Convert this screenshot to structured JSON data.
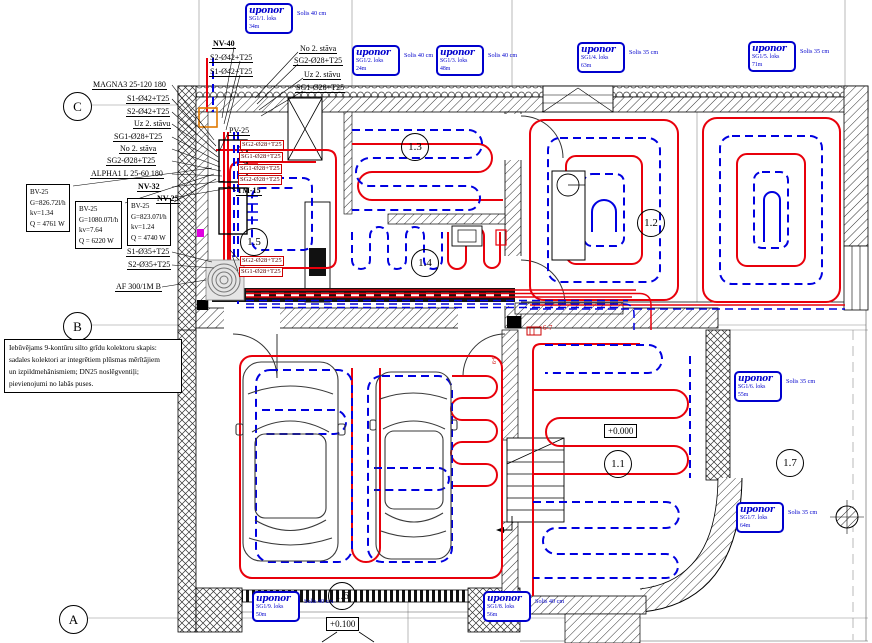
{
  "badges": [
    {
      "logo": "uponor",
      "loop": "SG1/1. loks",
      "len": "34m",
      "step": "Solis 40 cm"
    },
    {
      "logo": "uponor",
      "loop": "SG1/2. loks",
      "len": "24m",
      "step": "Solis 40 cm"
    },
    {
      "logo": "uponor",
      "loop": "SG1/3. loks",
      "len": "48m",
      "step": "Solis 40 cm"
    },
    {
      "logo": "uponor",
      "loop": "SG1/4. loks",
      "len": "63m",
      "step": "Solis 35 cm"
    },
    {
      "logo": "uponor",
      "loop": "SG1/5. loks",
      "len": "71m",
      "step": "Solis 35 cm"
    },
    {
      "logo": "uponor",
      "loop": "SG1/6. loks",
      "len": "55m",
      "step": "Solis 35 cm"
    },
    {
      "logo": "uponor",
      "loop": "SG1/7. loks",
      "len": "64m",
      "step": "Solis 35 cm"
    },
    {
      "logo": "uponor",
      "loop": "SG1/8. loks",
      "len": "56m",
      "step": "Solis 40 cm"
    },
    {
      "logo": "uponor",
      "loop": "SG1/9. loks",
      "len": "50m",
      "step": "Solis 40 cm"
    }
  ],
  "bv_boxes": [
    {
      "l1": "BV-25",
      "l2": "G=826.72l/h",
      "l3": "kv=1.34",
      "l4": "Q = 4761 W"
    },
    {
      "l1": "BV-25",
      "l2": "G=1080.07l/h",
      "l3": "kv=7.64",
      "l4": "Q = 6220 W"
    },
    {
      "l1": "BV-25",
      "l2": "G=823.07l/h",
      "l3": "kv=1.24",
      "l4": "Q = 4740 W"
    }
  ],
  "labels": {
    "nv40": "NV-40",
    "s2_42_a": "S2-Ø42+T25",
    "s1_42_a": "S1-Ø42+T25",
    "no2_a": "No 2. stāva",
    "sg2_28_a": "SG2-Ø28+T25",
    "uz2_a": "Uz 2. stāvu",
    "sg1_28_a": "SG1-Ø28+T25",
    "magna": "MAGNA3 25-120 180",
    "s1_42_b": "S1-Ø42+T25",
    "s2_42_b": "S2-Ø42+T25",
    "uz2_b": "Uz 2. stāvu",
    "sg1_28_b": "SG1-Ø28+T25",
    "no2_b": "No 2. stāva",
    "sg2_28_b": "SG2-Ø28+T25",
    "alpha": "ALPHA1 L 25-60 180",
    "nv32": "NV-32",
    "nv25": "NV-25",
    "pv25": "PV-25",
    "tm15": "TM-15",
    "s1_35": "S1-Ø35+T25",
    "s2_35": "S2-Ø35+T25",
    "af300": "AF 300/1M B"
  },
  "red_tags": [
    "SG2-Ø28+T25",
    "SG1-Ø28+T25",
    "SG1-Ø28+T25",
    "SG2-Ø28+T25",
    "SG2-Ø28+T25",
    "SG1-Ø28+T25"
  ],
  "note": {
    "line1": "Iebūvējams 9-kontūru silto grīdu kolektoru skapis:",
    "line2": "sadales kolektori ar integrētiem plūsmas mērītājiem",
    "line3": "un izpildmehānismiem; DN25 noslēgventiļi;",
    "line4": "pievienojumi no labās puses."
  },
  "rooms": {
    "r13": "1.3",
    "r15": "1.5",
    "r14": "1.4",
    "r12": "1.2",
    "r11": "1.1",
    "r17": "1.7",
    "r16": "1.6"
  },
  "grid": {
    "a": "A",
    "b": "B",
    "c": "C"
  },
  "elevations": {
    "ground": "+0.000",
    "garage": "+0.100"
  },
  "markers": {
    "red_small": "6-7",
    "red_vertical": "8-9"
  },
  "colors": {
    "supply_red": "#e8000b",
    "return_blue": "#0000e0",
    "uponor_blue": "#0000cd",
    "tag_red": "#cc0000"
  }
}
